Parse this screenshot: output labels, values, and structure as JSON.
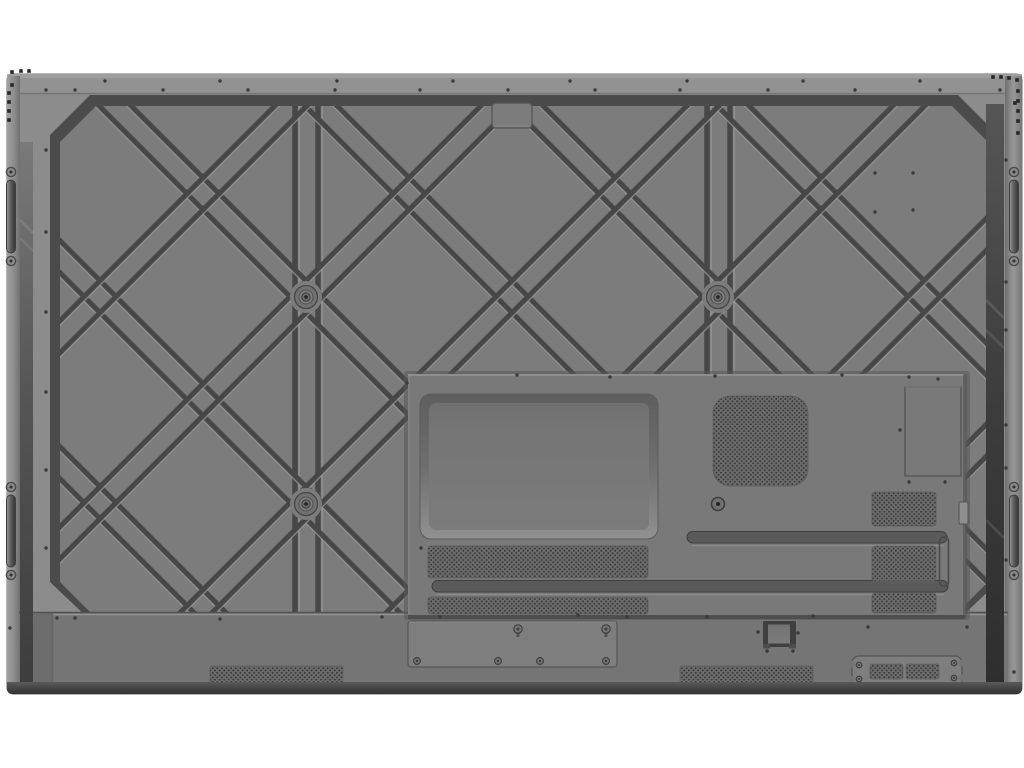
{
  "image": {
    "subject": "Rear view photograph of a large wall-mountable interactive flat panel display",
    "background": "#ffffff",
    "visible_text": "none"
  },
  "parts": {
    "backCover": {
      "label": "Back cover with reinforced rib lattice"
    },
    "lattice": {
      "label": "Diamond reinforcement rib pattern"
    },
    "vesa": {
      "label": "VESA mount bosses"
    },
    "module": {
      "label": "Electronics / OPS module bay"
    },
    "bayCover": {
      "label": "OPS bay cover plate"
    },
    "vent": {
      "label": "Ventilation perforation grid"
    },
    "slots": {
      "label": "Recessed cable routing slots"
    },
    "labelArea": {
      "label": "Rating label area"
    },
    "grilles": {
      "label": "Bottom speaker grilles"
    },
    "handles": {
      "label": "Side carrying handles"
    },
    "hook": {
      "label": "Wall-mount hook bracket"
    },
    "plateCenter": {
      "label": "Bottom connection plate"
    },
    "plateRight": {
      "label": "Bottom accessory plate"
    },
    "topTab": {
      "label": "Top hanger tab"
    },
    "bottomStrip": {
      "label": "Bottom speaker bar"
    }
  },
  "counts": {
    "vesa_bosses_visible": 3,
    "side_handles": 4,
    "speaker_grilles": 2,
    "perforated_vent_areas": 10
  },
  "colors": {
    "bg": "#ffffff",
    "marginGray": "#8c8c8c",
    "topStrip": "#939393",
    "panel": "#7c7c7c",
    "ridge": "#4b4b4b",
    "groove": "#474747",
    "grooveHi": "#9c9c9c",
    "module": "#797979",
    "recessFace": "#767676",
    "slot": "#5a5a5a",
    "strip": "#757575",
    "stripLip": "#9e9e9e",
    "plate": "#7e7e7e",
    "perfBase": "#6c6c6c",
    "perfDot": "#363636",
    "perfEdge": "#5e5e5e",
    "screwRing": "#3c3c3c",
    "screwFace": "#747474",
    "dotDark": "#3a3a3a",
    "sqDark": "#262626",
    "gapDark": "#3d3d3d",
    "bottomLip": "#4f4f4f",
    "bottomEdge": "#343434",
    "hookDark": "#3f3f3f",
    "hookInner": "#6e6e6e"
  }
}
